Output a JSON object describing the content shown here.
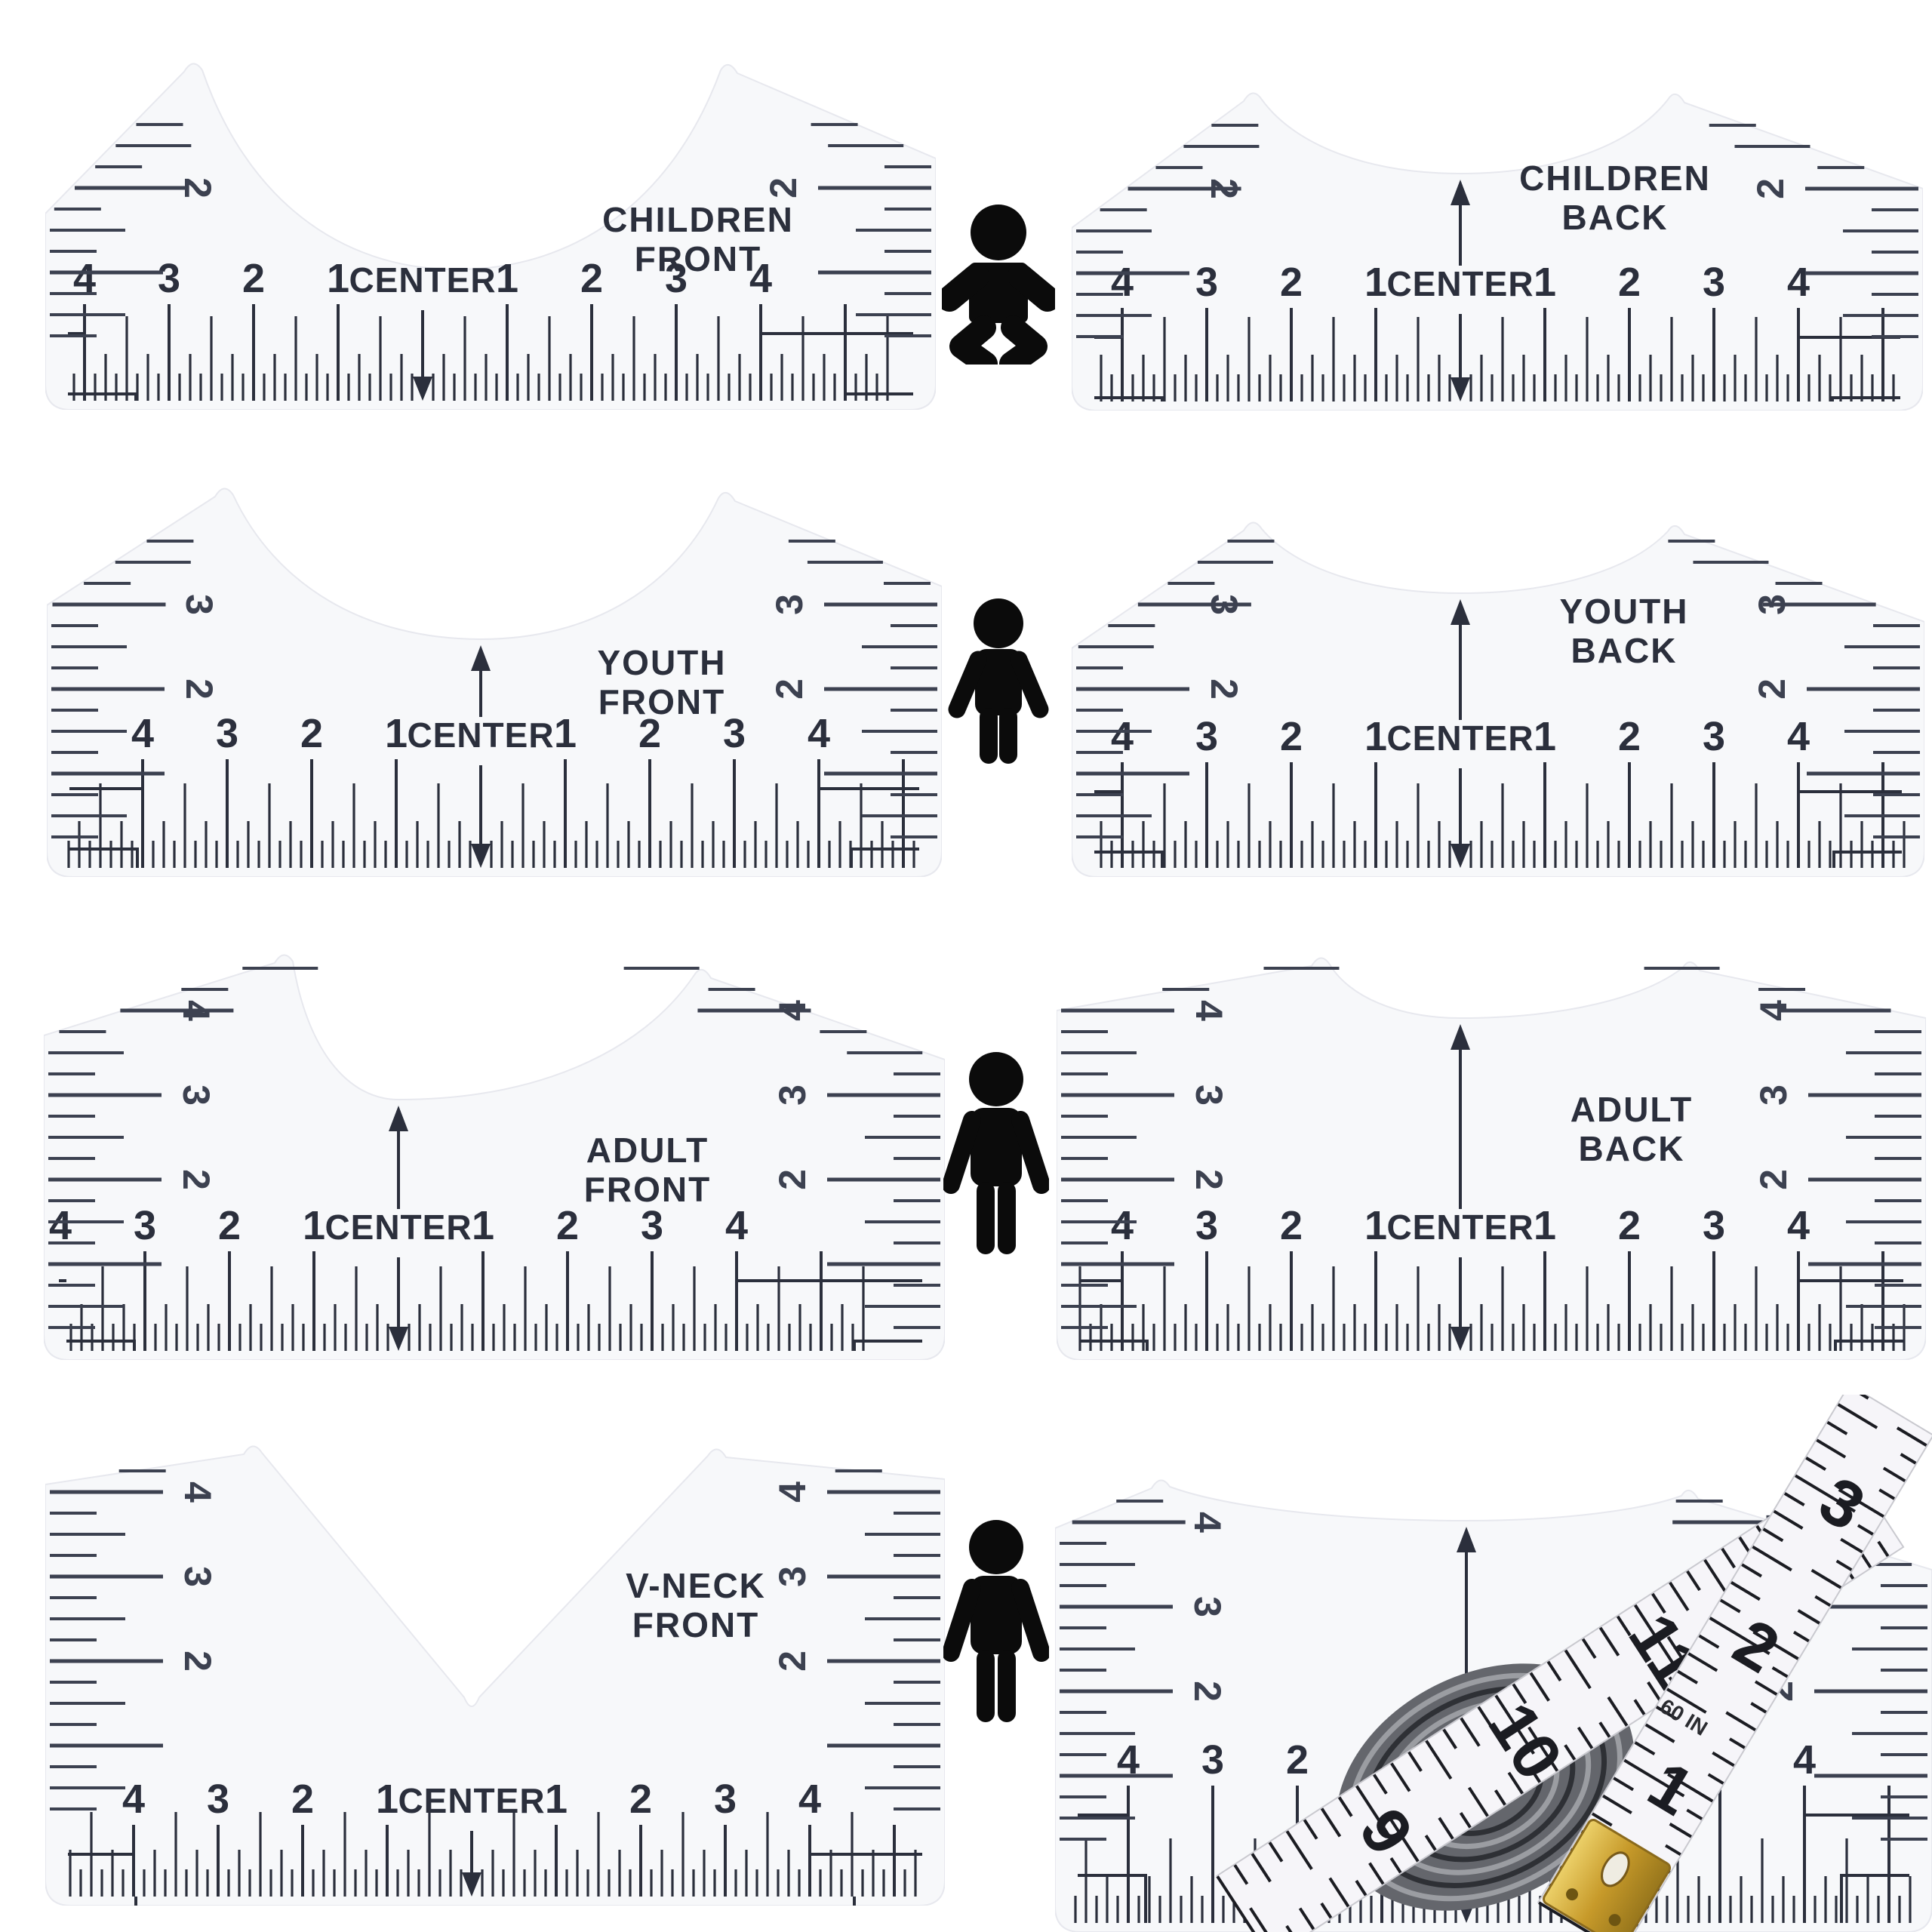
{
  "theme": {
    "background": "#ffffff",
    "ink": "#2b2f3c",
    "side_ink": "#3c4150",
    "plate_fill": "#f7f8fa",
    "plate_edge": "#e7e8ee",
    "icon_color": "#0b0b0b",
    "tape_white": "#f6f5f9",
    "tape_ink": "#1b1c22",
    "brass": "#c79a2a"
  },
  "rulers": [
    {
      "id": "children-front",
      "label_lines": [
        "CHILDREN",
        "FRONT"
      ],
      "center_label": "CENTER",
      "scale_numbers": [
        "4",
        "3",
        "2",
        "1"
      ],
      "side_numbers": [
        "2"
      ]
    },
    {
      "id": "children-back",
      "label_lines": [
        "CHILDREN",
        "BACK"
      ],
      "center_label": "CENTER",
      "scale_numbers": [
        "4",
        "3",
        "2",
        "1"
      ],
      "side_numbers": [
        "2"
      ]
    },
    {
      "id": "youth-front",
      "label_lines": [
        "YOUTH",
        "FRONT"
      ],
      "center_label": "CENTER",
      "scale_numbers": [
        "4",
        "3",
        "2",
        "1"
      ],
      "side_numbers": [
        "3",
        "2"
      ]
    },
    {
      "id": "youth-back",
      "label_lines": [
        "YOUTH",
        "BACK"
      ],
      "center_label": "CENTER",
      "scale_numbers": [
        "4",
        "3",
        "2",
        "1"
      ],
      "side_numbers": [
        "3",
        "2"
      ]
    },
    {
      "id": "adult-front",
      "label_lines": [
        "ADULT",
        "FRONT"
      ],
      "center_label": "CENTER",
      "scale_numbers": [
        "4",
        "3",
        "2",
        "1"
      ],
      "side_numbers": [
        "4",
        "3",
        "2"
      ]
    },
    {
      "id": "adult-back",
      "label_lines": [
        "ADULT",
        "BACK"
      ],
      "center_label": "CENTER",
      "scale_numbers": [
        "4",
        "3",
        "2",
        "1"
      ],
      "side_numbers": [
        "4",
        "3",
        "2"
      ]
    },
    {
      "id": "vneck-front",
      "label_lines": [
        "V-NECK",
        "FRONT"
      ],
      "center_label": "CENTER",
      "scale_numbers": [
        "4",
        "3",
        "2",
        "1"
      ],
      "side_numbers": [
        "4",
        "3",
        "2"
      ]
    },
    {
      "id": "tape-ruler",
      "label_lines": [],
      "center_label": "CENTER",
      "scale_numbers": [
        "4",
        "3",
        "2",
        "1"
      ],
      "side_numbers": [
        "4",
        "3",
        "2"
      ]
    }
  ],
  "icons": [
    {
      "name": "baby-icon"
    },
    {
      "name": "child-icon"
    },
    {
      "name": "adult-icon"
    },
    {
      "name": "adult-icon"
    }
  ],
  "tape": {
    "band_a_numbers": [
      "9",
      "10",
      "11"
    ],
    "band_b_numbers": [
      "1",
      "2",
      "3"
    ],
    "unit_label": "60 IN"
  }
}
